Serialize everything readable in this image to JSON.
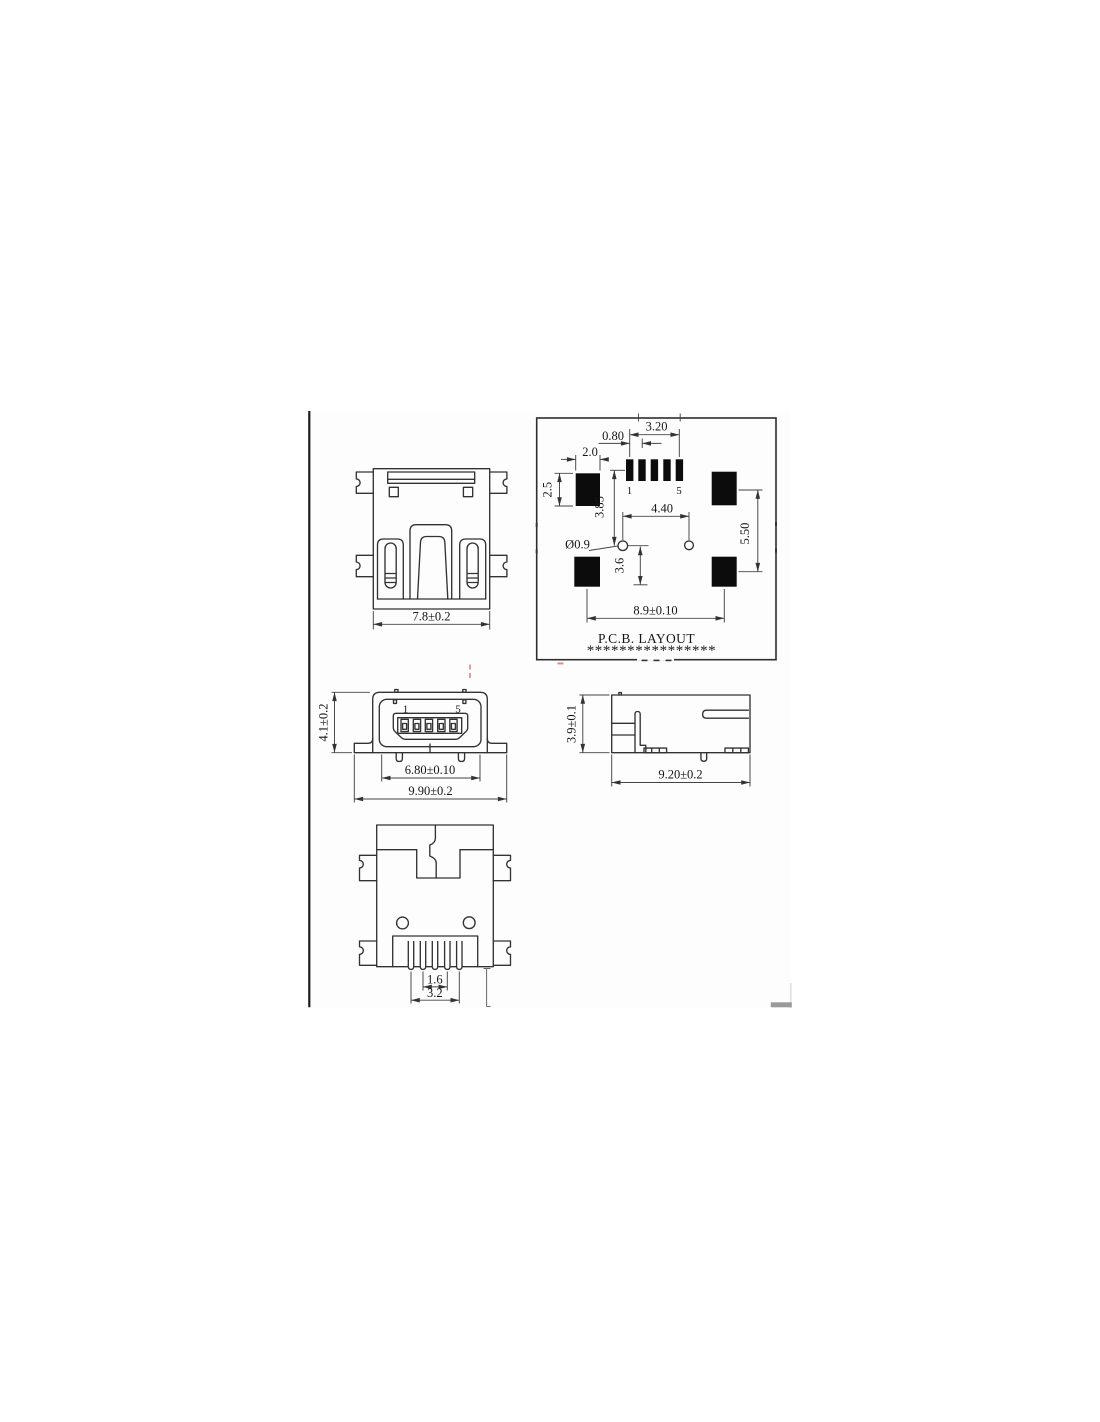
{
  "drawing": {
    "rear": {
      "width_dim": "7.8±0.2"
    },
    "pcb": {
      "title": "P.C.B. LAYOUT",
      "stars": "****************",
      "pin_first": "1",
      "pin_last": "5",
      "pin_span": "3.20",
      "pin_pitch": "0.80",
      "pad_w": "2.0",
      "pad_h": "2.5",
      "pin_to_hole": "3.85",
      "hole_span": "4.40",
      "hole_dia": "Ø0.9",
      "hole_to_pad": "3.6",
      "pad_col_span": "5.50",
      "pad_row_span": "8.9±0.10"
    },
    "front": {
      "pin_first": "1",
      "pin_last": "5",
      "height_dim": "4.1±0.2",
      "inner_width_dim": "6.80±0.10",
      "outer_width_dim": "9.90±0.2"
    },
    "side": {
      "height_dim": "3.9±0.1",
      "length_dim": "9.20±0.2"
    },
    "bottom": {
      "pitch_dim": "1.6",
      "span_dim": "3.2"
    }
  },
  "colors": {
    "line": "#333333",
    "pad": "#0c0c0c",
    "accent_red": "#e06666",
    "gray_bar": "#9a9a9a"
  }
}
